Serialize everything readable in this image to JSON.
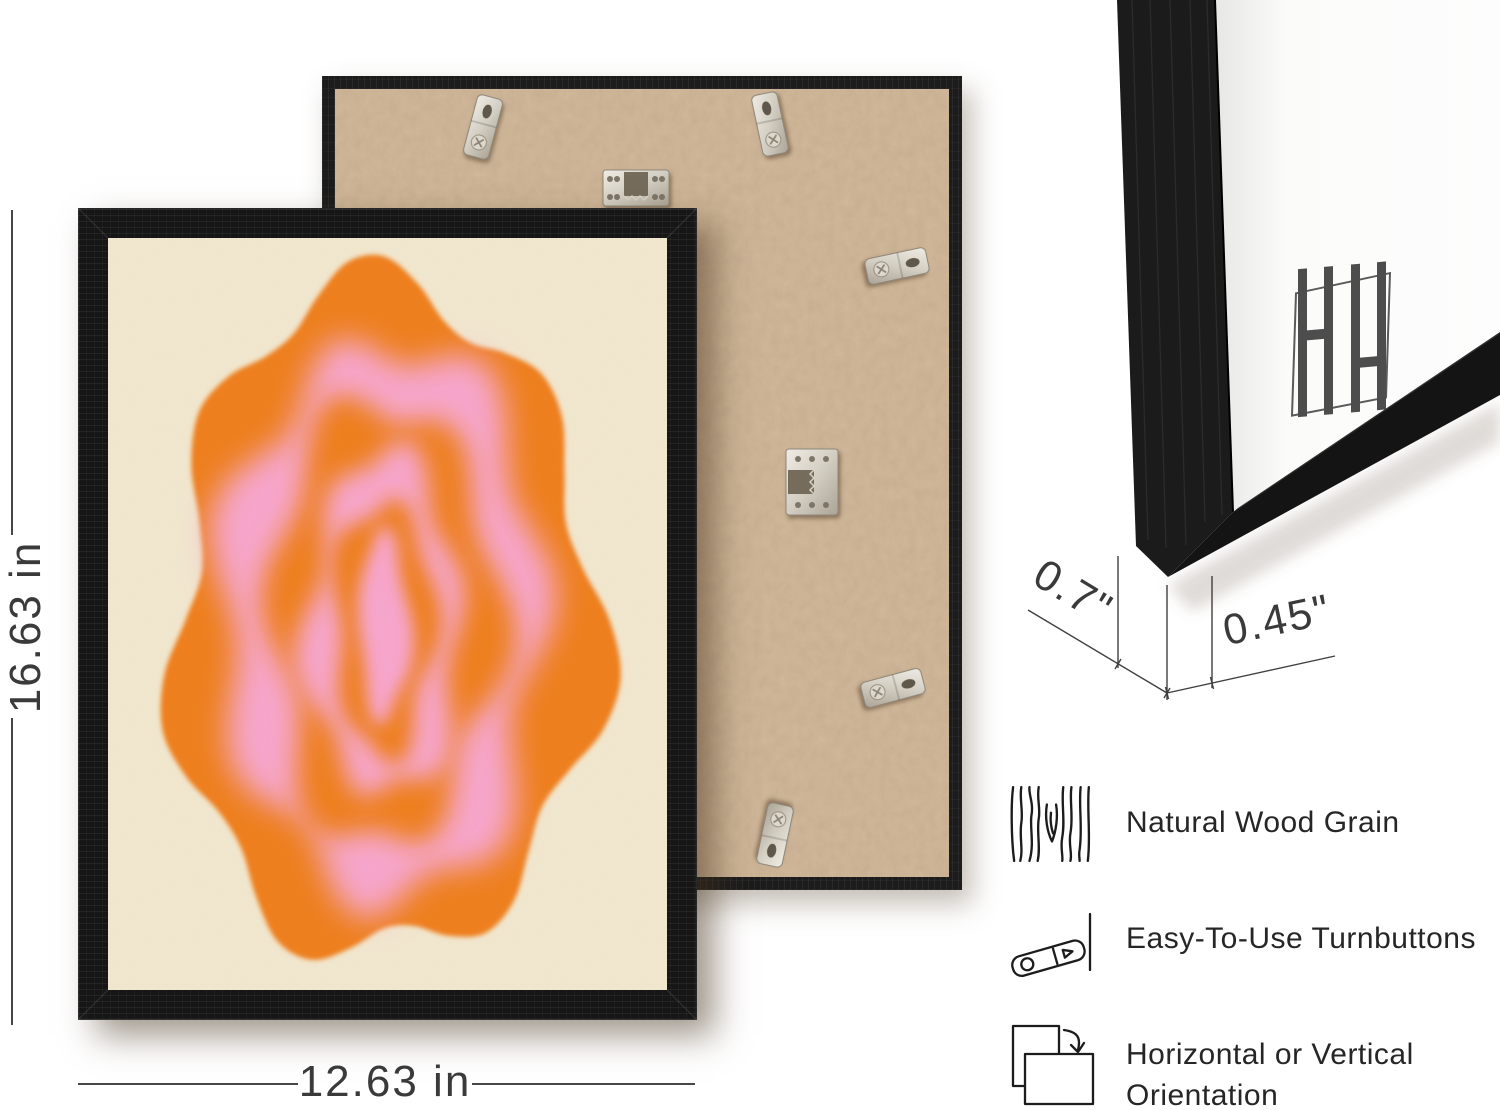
{
  "page": {
    "type": "product-infographic",
    "background": "#ffffff"
  },
  "dimension_annotations": {
    "height_label": "16.63 in",
    "width_label": "12.63 in",
    "depth_label": "0.7\"",
    "moulding_width_label": "0.45\""
  },
  "features": [
    {
      "icon": "wood-grain-icon",
      "label": "Natural Wood Grain"
    },
    {
      "icon": "turnbutton-icon",
      "label": "Easy-To-Use Turnbuttons"
    },
    {
      "icon": "orientation-icon",
      "label_line1": "Horizontal or Vertical",
      "label_line2": "Orientation"
    }
  ],
  "front_frame": {
    "description": "black wood picture frame with abstract wavy concentric ring artwork",
    "frame_color": "#161616",
    "artwork": {
      "background": "#f2e8d0",
      "orange": "#ef7f1a",
      "pink": "#f8a6cd"
    }
  },
  "back_frame": {
    "description": "rear of frame showing MDF backing board and metal fittings",
    "board_color": "#bc9e7e",
    "frame_color": "#1c1c1c",
    "hardware": [
      "turnbutton",
      "sawtooth-hanger"
    ]
  },
  "corner_frame": {
    "description": "close-up corner of black frame with white mat",
    "mat_color": "#fbfbfa",
    "logo_monogram": "HH"
  }
}
